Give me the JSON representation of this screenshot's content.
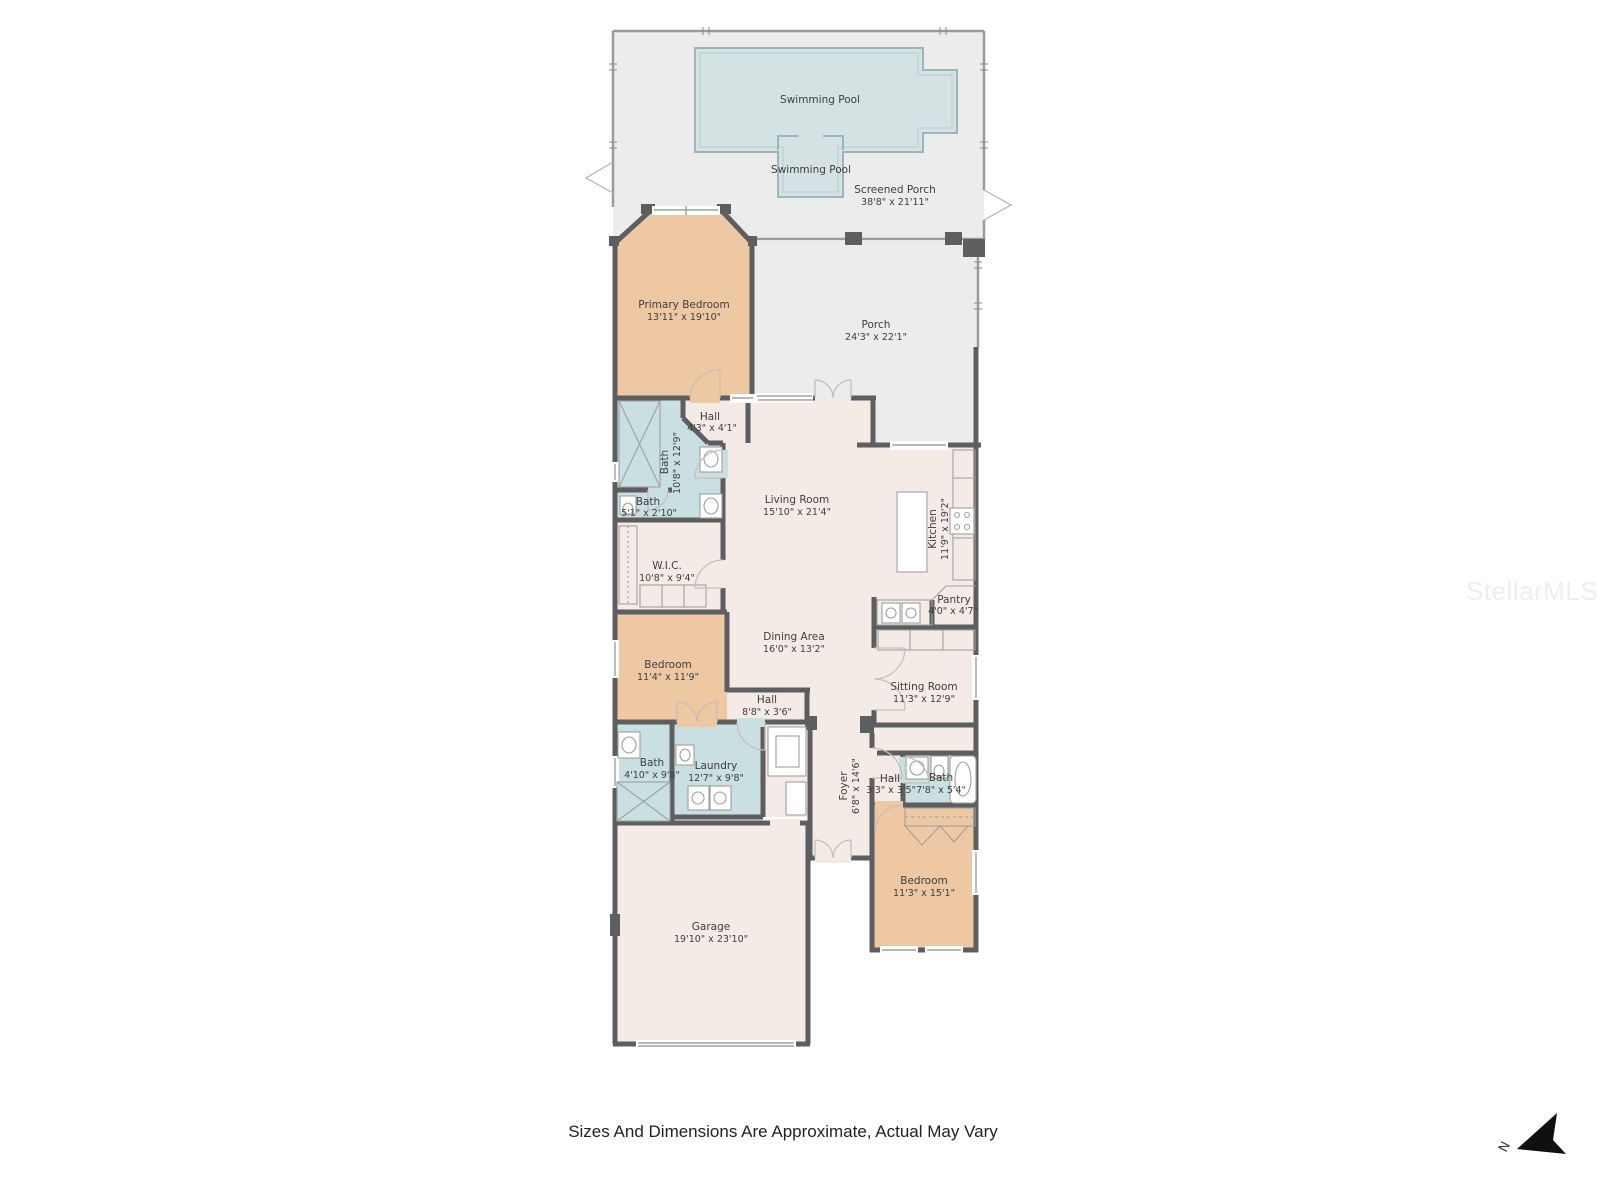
{
  "disclaimer": "Sizes And Dimensions Are Approximate, Actual May Vary",
  "watermark": {
    "text": "StellarMLS"
  },
  "compass": {
    "north_label": "N"
  },
  "colors": {
    "porch_gray": "#ececec",
    "room_cream": "#f5ebe6",
    "bath_blue": "#c9dfe1",
    "bedroom_tan": "#eec8a3",
    "pool_blue": "#d5e2e4",
    "wall_dark": "#5d5e60"
  },
  "rooms": {
    "screened_porch": {
      "name": "Screened Porch",
      "dims": "38'8\" x 21'11\""
    },
    "pool_main": {
      "name": "Swimming Pool",
      "dims": ""
    },
    "pool_spa": {
      "name": "Swimming Pool",
      "dims": ""
    },
    "primary_bedroom": {
      "name": "Primary Bedroom",
      "dims": "13'11\" x 19'10\""
    },
    "porch": {
      "name": "Porch",
      "dims": "24'3\" x 22'1\""
    },
    "hall_upper": {
      "name": "Hall",
      "dims": "4'3\" x 4'1\""
    },
    "bath_primary": {
      "name": "Bath",
      "dims": "10'8\" x 12'9\""
    },
    "bath_toilet": {
      "name": "Bath",
      "dims": "5'1\" x 2'10\""
    },
    "wic": {
      "name": "W.I.C.",
      "dims": "10'8\" x 9'4\""
    },
    "living_room": {
      "name": "Living Room",
      "dims": "15'10\" x 21'4\""
    },
    "kitchen": {
      "name": "Kitchen",
      "dims": "11'9\" x 19'2\""
    },
    "pantry": {
      "name": "Pantry",
      "dims": "4'0\" x 4'7\""
    },
    "dining_area": {
      "name": "Dining Area",
      "dims": "16'0\" x 13'2\""
    },
    "bedroom_mid": {
      "name": "Bedroom",
      "dims": "11'4\" x 11'9\""
    },
    "hall_mid": {
      "name": "Hall",
      "dims": "8'8\" x 3'6\""
    },
    "sitting_room": {
      "name": "Sitting Room",
      "dims": "11'3\" x 12'9\""
    },
    "bath_mid": {
      "name": "Bath",
      "dims": "4'10\" x 9'8\""
    },
    "laundry": {
      "name": "Laundry",
      "dims": "12'7\" x 9'8\""
    },
    "foyer": {
      "name": "Foyer",
      "dims": "6'8\" x 14'6\""
    },
    "hall_rear": {
      "name": "Hall",
      "dims": "3'3\" x 3'5\""
    },
    "bath_rear": {
      "name": "Bath",
      "dims": "7'8\" x 5'4\""
    },
    "bedroom_rear": {
      "name": "Bedroom",
      "dims": "11'3\" x 15'1\""
    },
    "garage": {
      "name": "Garage",
      "dims": "19'10\" x 23'10\""
    }
  }
}
